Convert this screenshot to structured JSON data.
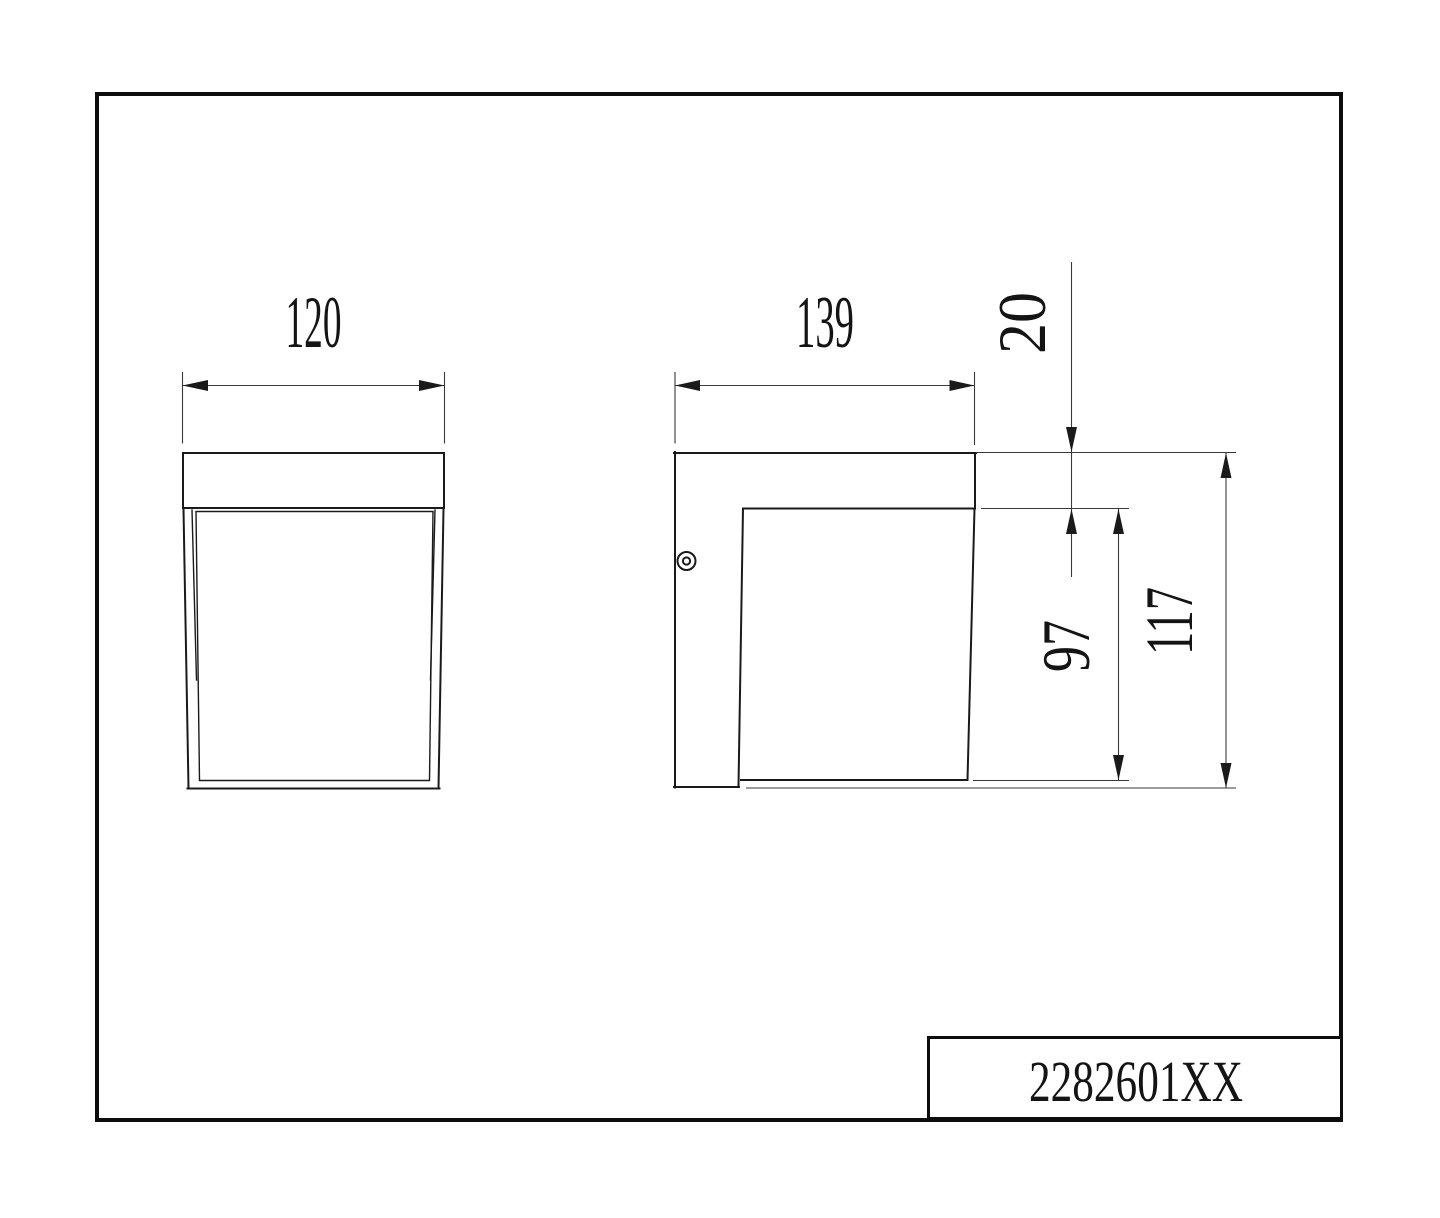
{
  "page": {
    "background": "#ffffff",
    "line_color": "#1a1a1a"
  },
  "title_block": {
    "part_number": "2282601XX"
  },
  "front_view": {
    "width_mm": "120"
  },
  "side_view": {
    "depth_mm": "139",
    "cap_height_mm": "20",
    "body_height_mm": "97",
    "total_height_mm": "117"
  }
}
